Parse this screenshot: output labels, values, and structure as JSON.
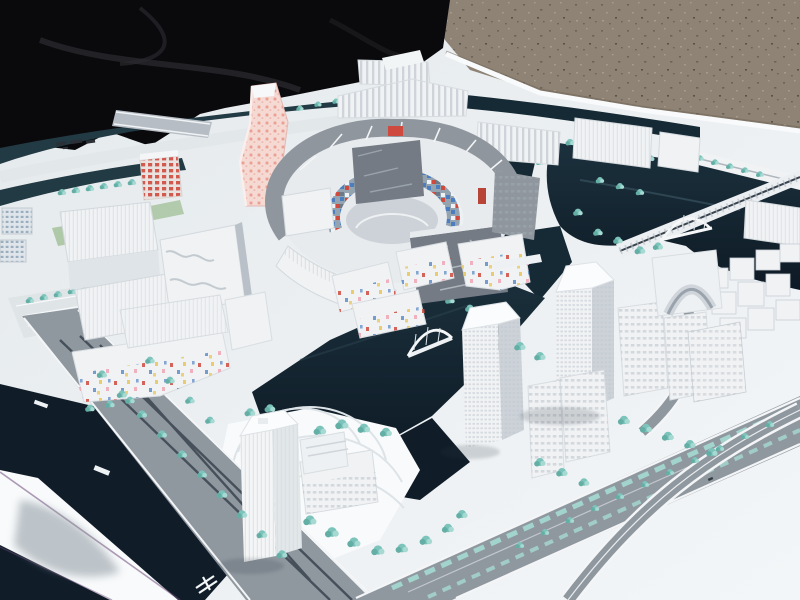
{
  "scene": {
    "type": "photograph",
    "description": "Outdoor photograph of a white architectural scale model of a waterfront urban master plan, viewed at an angle. The model board sits on gravel ground with a black tarp covering the upper-left corner. The model shows white buildings, dark navy canals, teal model trees, gray boulevards, a twisting pink-dotted tower, an oval courtyard complex with a multicolored mosaic inner wall, tall office towers to the east, a translucent tower to the south, arch bridges, and tiny illegible markings on roads and board.",
    "landmarks": [
      {
        "name": "black-tarp",
        "description": "dark fabric tarp draped over the upper-left corner of the scene"
      },
      {
        "name": "gravel-ground",
        "description": "brown-gray gravel ground behind the model board"
      },
      {
        "name": "model-board",
        "description": "large white base board holding the model, seen in perspective"
      },
      {
        "name": "northwest-canal",
        "description": "curved dark canal bands with a straight gray bridge near the top-left"
      },
      {
        "name": "spiral-tower",
        "description": "twisting high-rise tower with pale pink facade and red dot grid"
      },
      {
        "name": "oval-courtyard-complex",
        "description": "ring of gray-roofed buildings around a court; inner wall banded with red, blue and white mosaic tiles"
      },
      {
        "name": "sawtooth-workshops",
        "description": "striped sawtooth-roof industrial buildings along the north edge"
      },
      {
        "name": "west-blocks",
        "description": "large white mixed-use blocks with wavy facades on the west side"
      },
      {
        "name": "confetti-building-west",
        "description": "low white building with scattered red, blue and yellow facade tiles"
      },
      {
        "name": "confetti-buildings-center",
        "description": "curved low buildings with pastel confetti facades beside the canal"
      },
      {
        "name": "grand-canal",
        "description": "wide dark navy canal crossing the middle of the model"
      },
      {
        "name": "east-water-basin",
        "description": "large dark basin on the east side with tree-lined piers"
      },
      {
        "name": "east-office-tower",
        "description": "tall white office tower with fine window grid"
      },
      {
        "name": "mid-office-tower",
        "description": "second white tower near the center-south"
      },
      {
        "name": "south-translucent-tower",
        "description": "milky translucent tower on a fan-shaped striped plaza"
      },
      {
        "name": "cube-cluster-east",
        "description": "cluster of small white cube housing blocks at the right edge"
      },
      {
        "name": "arch-building",
        "description": "white building with a large arched opening near the east basin"
      },
      {
        "name": "truss-arch-bridge",
        "description": "white arched truss bridge over the east basin"
      },
      {
        "name": "center-arch-bridge",
        "description": "white arch footbridge over the grand canal"
      },
      {
        "name": "boulevard",
        "description": "wide gray boulevard with teal planted medians running to the lower-right"
      },
      {
        "name": "ramp-road",
        "description": "curved white-edged ramp road at the lower-right"
      },
      {
        "name": "rail-corridor",
        "description": "light rail strip with dark center line crossing the east basin"
      },
      {
        "name": "board-annotation-marks",
        "description": "tiny dark illegible marks printed on the board near the top-left"
      },
      {
        "name": "rail-symbol-marking",
        "description": "small white illegible symbol painted on the southwest road"
      },
      {
        "name": "road-text-markings",
        "description": "tiny white illegible road labels on the west road"
      }
    ]
  },
  "colors": {
    "tarp": "#0a0a0d",
    "tarpFold": "#28282d",
    "gravel": "#8e8375",
    "gravelDark": "#6d6356",
    "gravelLight": "#a79d8d",
    "board": "#e9edf0",
    "boardBright": "#f8fafb",
    "boardShade": "#d7dde2",
    "waterDark": "#101d29",
    "water": "#162a35",
    "waterSlate": "#223a43",
    "road": "#8f979f",
    "roadDark": "#39434d",
    "curb": "#f3f5f7",
    "lane": "#cfd5da",
    "tree": "#7cc4bb",
    "treeDark": "#63aea5",
    "treeLight": "#a5d9d1",
    "grass": "#a3c29b",
    "bldg": "#f0f2f4",
    "bldgSide": "#ccd2d8",
    "bldgDark": "#747b84",
    "roof": "#8f969e",
    "pink": "#f5dad4",
    "pinkDot": "#e78f84",
    "red": "#cf4a3e",
    "blue": "#4a7ec0",
    "yellow": "#e9c862",
    "rosePink": "#f0a9b8",
    "shadow": "#8d99a1",
    "magenta": "#6b4a78"
  }
}
